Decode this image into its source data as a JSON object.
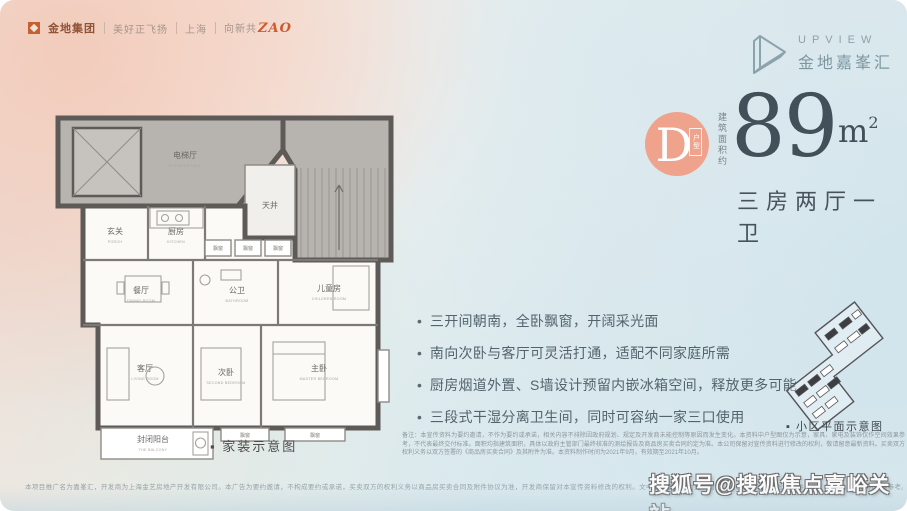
{
  "brand_bar": {
    "logo_text": "金地集团",
    "slogan_1": "美好正飞扬",
    "slogan_2": "上海",
    "slogan_3_prefix": "向新共",
    "slogan_3_accent": "ZAO"
  },
  "project_logo": {
    "name_en": "UPVIEW",
    "name_cn": "金地嘉峯汇"
  },
  "unit": {
    "badge_letter": "D",
    "badge_tag": "户型",
    "badge_color": "#efa28c",
    "area_prefix": "建筑面积约",
    "area_value": "89",
    "area_unit_letter": "m",
    "area_unit_sup": "2",
    "layout_text": "三房两厅一卫",
    "number_color": "#42505a"
  },
  "bullets": {
    "feature": "•"
  },
  "features": [
    "三开间朝南，全卧飘窗，开阔采光面",
    "南向次卧与客厅可灵活打通，适配不同家庭所需",
    "厨房烟道外置、S墙设计预留内嵌冰箱空间，释放更多可能",
    "三段式干湿分离卫生间，同时可容纳一家三口使用"
  ],
  "floorplan": {
    "caption": "▪ 家装示意图",
    "rooms": {
      "elevator_hall": {
        "cn": "电梯厅",
        "en": "ELEVATOR HALL"
      },
      "patio": {
        "cn": "天井"
      },
      "entry": {
        "cn": "玄关",
        "en": "PORCH"
      },
      "kitchen": {
        "cn": "厨房",
        "en": "KITCHEN"
      },
      "bay_window": {
        "cn": "飘窗",
        "en": "BAY WINDOW"
      },
      "children": {
        "cn": "儿童房",
        "en": "CHILDREN ROOM"
      },
      "dining": {
        "cn": "餐厅",
        "en": "DINING ROOM"
      },
      "bath": {
        "cn": "公卫",
        "en": "BATHROOM"
      },
      "living": {
        "cn": "客厅",
        "en": "LIVING ROOM"
      },
      "second_bed": {
        "cn": "次卧",
        "en": "SECOND BEDROOM"
      },
      "master_bed": {
        "cn": "主卧",
        "en": "MASTER BEDROOM"
      },
      "balcony": {
        "cn": "封闭阳台",
        "en": "THE BALCONY"
      }
    }
  },
  "siteplan": {
    "caption": "▪ 小区平面示意图"
  },
  "disclaimers": {
    "right_block": "备注：本宣传资料为要约邀请，不作为要约或承诺，相关内容不排除因政府规划、规定及开发商未能控制等原因而发生变化。本资料中户型图仅为示意，家具、家电及装饰仅作空间效果参考，不代表最终交付标准。面积均指建筑面积，具体以政府主管部门最终核准的测绘报告及商品房买卖合同约定为准。本公司保留对宣传资料进行修改的权利，敬请留意最新资料。买卖双方权利义务以双方签署的《商品房买卖合同》及其附件为准。本资料制作时间为2021年9月，有效期至2021年10月。",
    "bottom_line": "本项目推广名为嘉峯汇，开发商为上海金艺房地产开发有限公司。本广告为要约邀请，不构成要约或承诺，买卖双方的权利义务以商品房买卖合同及附件协议为准，开发商保留对本宣传资料修改的权利。文中涉及面积均为建筑面积，交付标准以政府批准文件为准，图片及文字说明仅供参考。"
  },
  "watermark": "搜狐号@搜狐焦点嘉峪关站"
}
